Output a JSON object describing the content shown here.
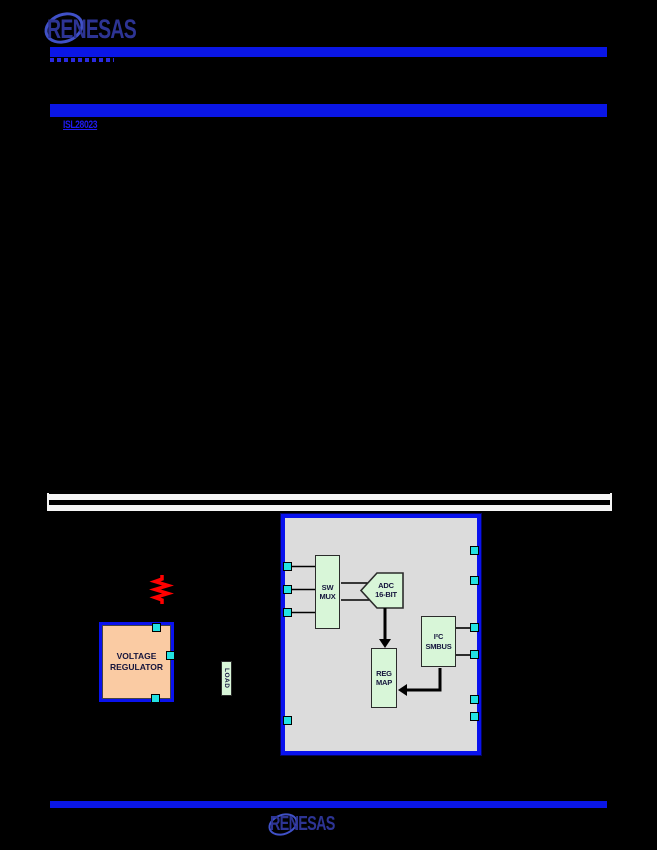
{
  "page": {
    "background": "#000000"
  },
  "header": {
    "brand": "RENESAS",
    "part_link": "ISL28023"
  },
  "footer": {
    "brand": "RENESAS"
  },
  "diagram": {
    "ic": {
      "sw_mux_label": "SW\nMUX",
      "adc_label": "ADC\n16-BIT",
      "i2c_label": "I²C\nSMBUS",
      "reg_map_label": "REG\nMAP"
    },
    "voltage_regulator_label": "VOLTAGE\nREGULATOR",
    "load_label": "LOAD"
  },
  "colors": {
    "rule_blue": "#0A16E6",
    "ic_border_blue": "#0912EE",
    "ic_fill_grey": "#DCDCDC",
    "block_green": "#D8F6D8",
    "regulator_peach": "#FACBA3",
    "pin_cyan": "#22E2E2",
    "sense_resistor_red": "#FF0000",
    "link_blue": "#1F1BF2",
    "logo_navy": "#2D3494",
    "divider_white": "#F5F5F5"
  }
}
